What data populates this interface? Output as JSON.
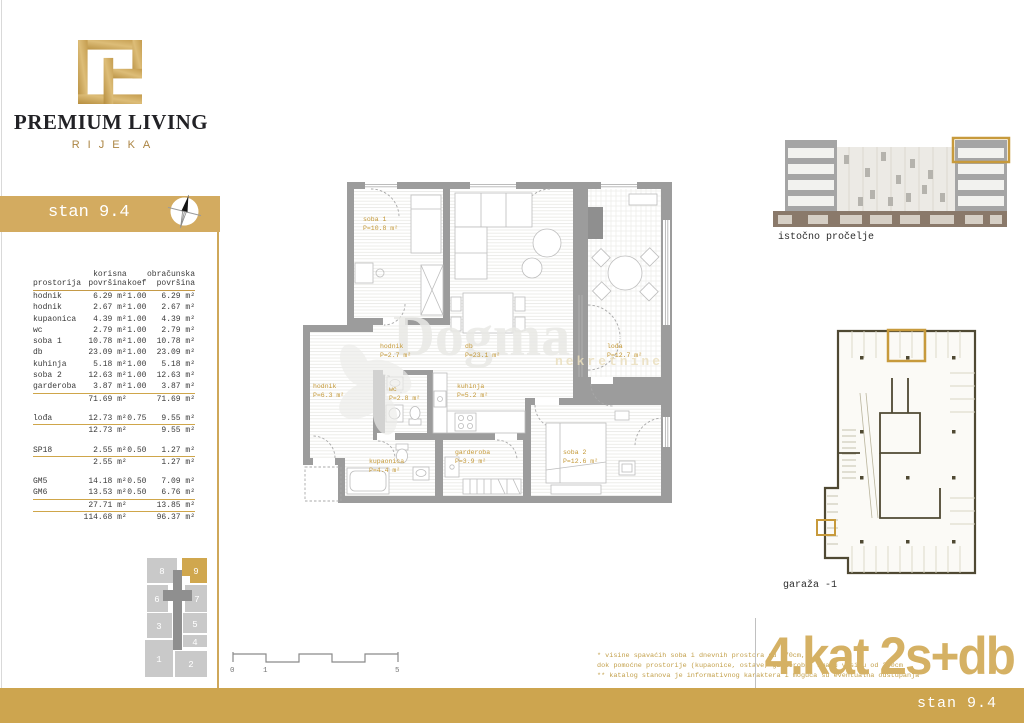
{
  "brand": {
    "name": "PREMIUM LIVING",
    "city": "RIJEKA"
  },
  "sidebar": {
    "unit_title": "stan 9.4",
    "table": {
      "headers": {
        "room": "prostorija",
        "net1": "korisna",
        "net2": "površina",
        "koef": "koef",
        "calc1": "obračunska",
        "calc2": "površina"
      },
      "rows": [
        {
          "t": "r",
          "name": "hodnik",
          "net": "6.29 m²",
          "koef": "1.00",
          "calc": "6.29 m²"
        },
        {
          "t": "r",
          "name": "hodnik",
          "net": "2.67 m²",
          "koef": "1.00",
          "calc": "2.67 m²"
        },
        {
          "t": "r",
          "name": "kupaonica",
          "net": "4.39 m²",
          "koef": "1.00",
          "calc": "4.39 m²"
        },
        {
          "t": "r",
          "name": "wc",
          "net": "2.79 m²",
          "koef": "1.00",
          "calc": "2.79 m²"
        },
        {
          "t": "r",
          "name": "soba 1",
          "net": "10.78 m²",
          "koef": "1.00",
          "calc": "10.78 m²"
        },
        {
          "t": "r",
          "name": "db",
          "net": "23.09 m²",
          "koef": "1.00",
          "calc": "23.09 m²"
        },
        {
          "t": "r",
          "name": "kuhinja",
          "net": "5.18 m²",
          "koef": "1.00",
          "calc": "5.18 m²"
        },
        {
          "t": "r",
          "name": "soba 2",
          "net": "12.63 m²",
          "koef": "1.00",
          "calc": "12.63 m²"
        },
        {
          "t": "r",
          "name": "garderoba",
          "net": "3.87 m²",
          "koef": "1.00",
          "calc": "3.87 m²"
        },
        {
          "t": "sum",
          "name": "",
          "net": "71.69 m²",
          "koef": "",
          "calc": "71.69 m²"
        },
        {
          "t": "gap",
          "name": "",
          "net": "",
          "koef": "",
          "calc": ""
        },
        {
          "t": "r",
          "name": "lođa",
          "net": "12.73 m²",
          "koef": "0.75",
          "calc": "9.55 m²"
        },
        {
          "t": "sum",
          "name": "",
          "net": "12.73 m²",
          "koef": "",
          "calc": "9.55 m²"
        },
        {
          "t": "gap",
          "name": "",
          "net": "",
          "koef": "",
          "calc": ""
        },
        {
          "t": "r",
          "name": "SP18",
          "net": "2.55 m²",
          "koef": "0.50",
          "calc": "1.27 m²"
        },
        {
          "t": "sum",
          "name": "",
          "net": "2.55 m²",
          "koef": "",
          "calc": "1.27 m²"
        },
        {
          "t": "gap",
          "name": "",
          "net": "",
          "koef": "",
          "calc": ""
        },
        {
          "t": "r",
          "name": "GM5",
          "net": "14.18 m²",
          "koef": "0.50",
          "calc": "7.09 m²"
        },
        {
          "t": "r",
          "name": "GM6",
          "net": "13.53 m²",
          "koef": "0.50",
          "calc": "6.76 m²"
        },
        {
          "t": "sum",
          "name": "",
          "net": "27.71 m²",
          "koef": "",
          "calc": "13.85 m²"
        },
        {
          "t": "total",
          "name": "",
          "net": "114.68 m²",
          "koef": "",
          "calc": "96.37 m²"
        }
      ]
    },
    "stack": {
      "blocks": [
        "8",
        "9",
        "6",
        "7",
        "3",
        "5",
        "4",
        "1",
        "2"
      ]
    }
  },
  "plan": {
    "rooms": {
      "soba1": {
        "name": "soba 1",
        "area": "P=10.8 m²"
      },
      "db": {
        "name": "db",
        "area": "P=23.1 m²"
      },
      "loda": {
        "name": "lođa",
        "area": "P=12.7 m²"
      },
      "hodnik2": {
        "name": "hodnik",
        "area": "P=2.7 m²"
      },
      "hodnik6": {
        "name": "hodnik",
        "area": "P=6.3 m²"
      },
      "wc": {
        "name": "wc",
        "area": "P=2.8 m²"
      },
      "kuhinja": {
        "name": "kuhinja",
        "area": "P=5.2 m²"
      },
      "kupaonica": {
        "name": "kupaonica",
        "area": "P=4.4 m²"
      },
      "garderoba": {
        "name": "garderoba",
        "area": "P=3.9 m²"
      },
      "soba2": {
        "name": "soba 2",
        "area": "P=12.6 m²"
      }
    },
    "watermark": {
      "name": "Dogma",
      "sub": "nekretnine"
    }
  },
  "right_panel": {
    "elevation_label": "istočno pročelje",
    "garage_label": "garaža -1"
  },
  "footer": {
    "scale_ticks": [
      "0",
      "1",
      "5"
    ],
    "notes": [
      "* visine spavaćih soba i dnevnih prostora su 270cm,",
      "dok pomoćne prostorije (kupaonice, ostave, garderobe) imaju visinu od 250cm",
      "** katalog stanova je informativnog karaktera i moguća su eventualna odstupanja"
    ],
    "floor_label": "4.kat 2s+db",
    "unit_label": "stan 9.4"
  },
  "colors": {
    "gold": "#d3ab60",
    "bar_gold": "#cda54f",
    "label_gold": "#c49836",
    "wall_grey": "#9c9c9c"
  }
}
